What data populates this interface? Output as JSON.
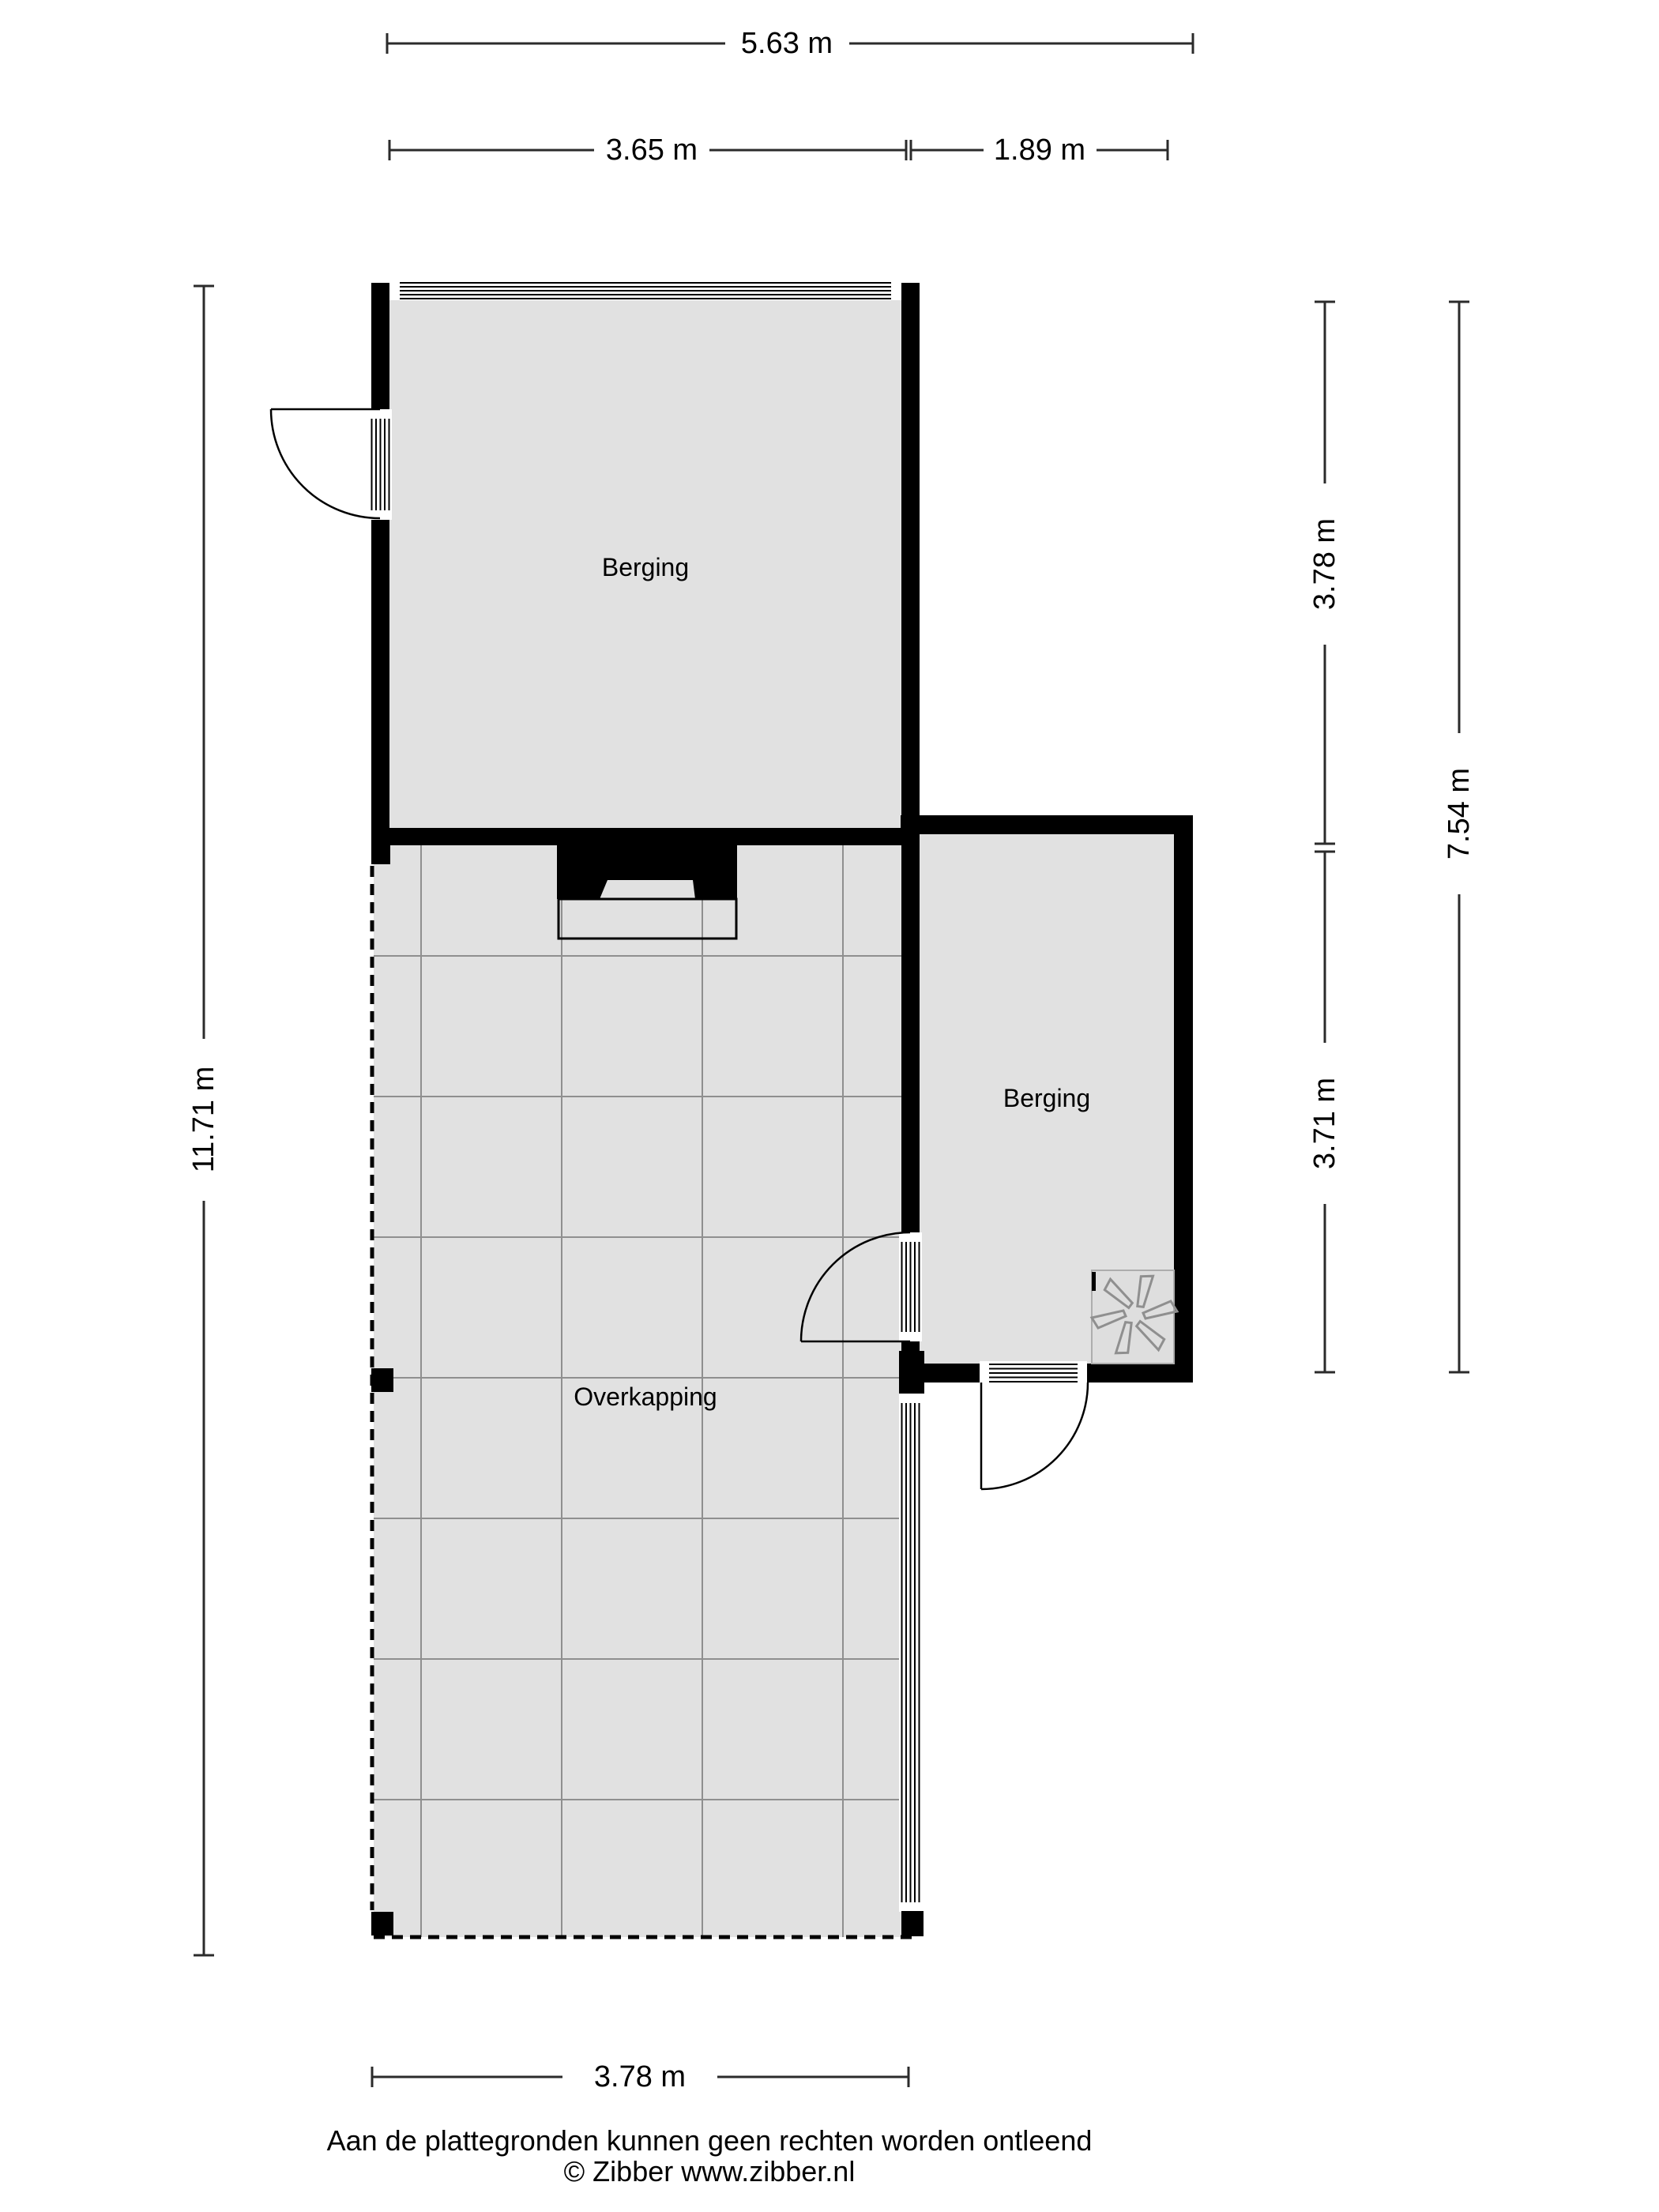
{
  "plan": {
    "rooms": [
      {
        "id": "berging-1",
        "label": "Berging"
      },
      {
        "id": "berging-2",
        "label": "Berging"
      },
      {
        "id": "overkapping",
        "label": "Overkapping"
      }
    ],
    "dimensions": {
      "top_total": "5.63 m",
      "top_segment_left": "3.65 m",
      "top_segment_right": "1.89 m",
      "left_total": "11.71 m",
      "right_upper": "3.78 m",
      "right_lower": "3.71 m",
      "right_total": "7.54 m",
      "bottom": "3.78 m"
    },
    "symbols": {
      "ventilation_fan": "6-blade fan glyph"
    }
  },
  "footer": {
    "disclaimer": "Aan de plattegronden kunnen geen rechten worden ontleend",
    "copyright": "© Zibber www.zibber.nl"
  },
  "colors": {
    "wall": "#000000",
    "floor": "#e1e1e1",
    "grid_line": "#8f8f8f",
    "dimension_line": "#2b2b2b",
    "text": "#000000",
    "fan_stroke": "#8f8f8f",
    "background": "#ffffff"
  }
}
